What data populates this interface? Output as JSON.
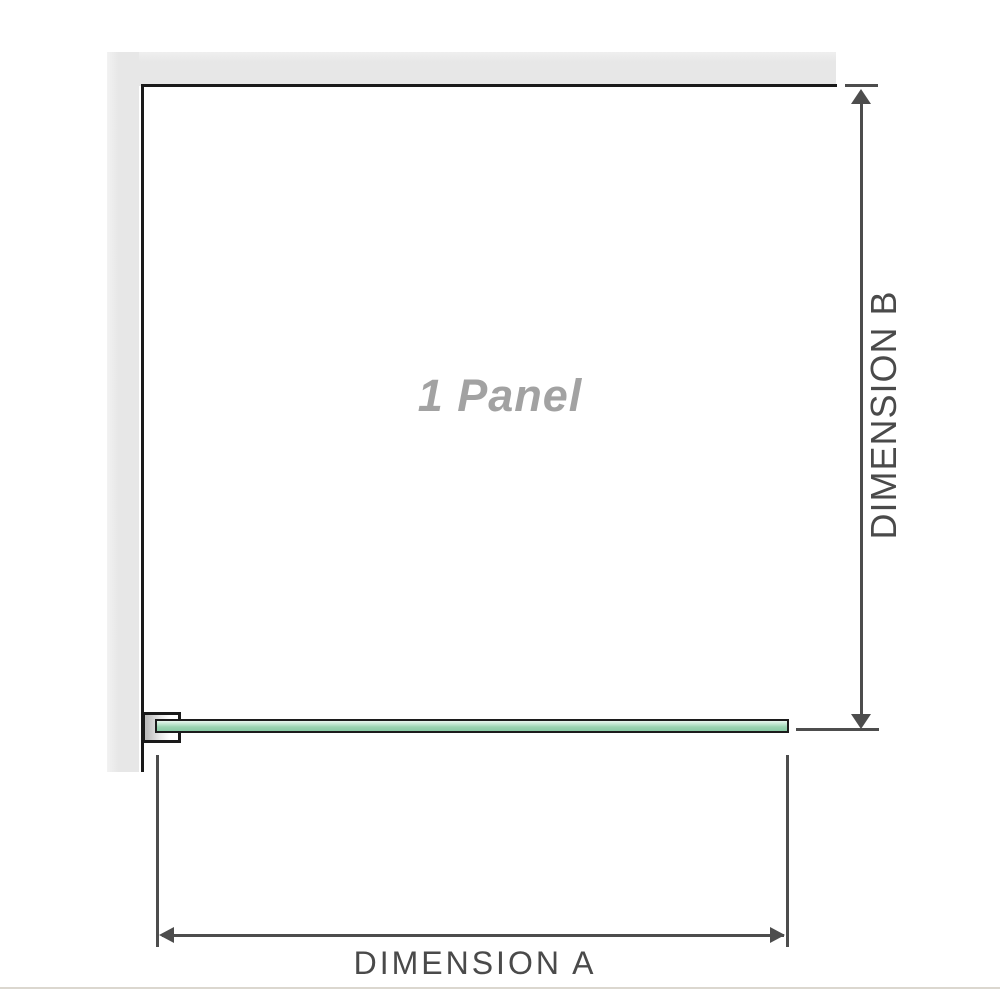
{
  "diagram": {
    "panel_label": "1 Panel",
    "dimension_a": {
      "label": "DIMENSION A"
    },
    "dimension_b": {
      "label": "DIMENSION B"
    }
  },
  "icons": {
    "dimension_b_top": "arrow-up-icon",
    "dimension_b_bottom": "arrow-down-icon",
    "dimension_a_left": "arrow-left-icon",
    "dimension_a_right": "arrow-right-icon"
  },
  "colors": {
    "wall_gray": "#e7e7e7",
    "outline_black": "#1a1a1a",
    "dimension_line": "#4d4d4d",
    "label_text": "#4a4a4a",
    "panel_label_text": "#a2a2a2",
    "glass_border": "#1c1c1c",
    "glass_green": "#9bd4b2",
    "glass_green_light": "#e9f7ef",
    "divider": "#dbd7cf"
  }
}
